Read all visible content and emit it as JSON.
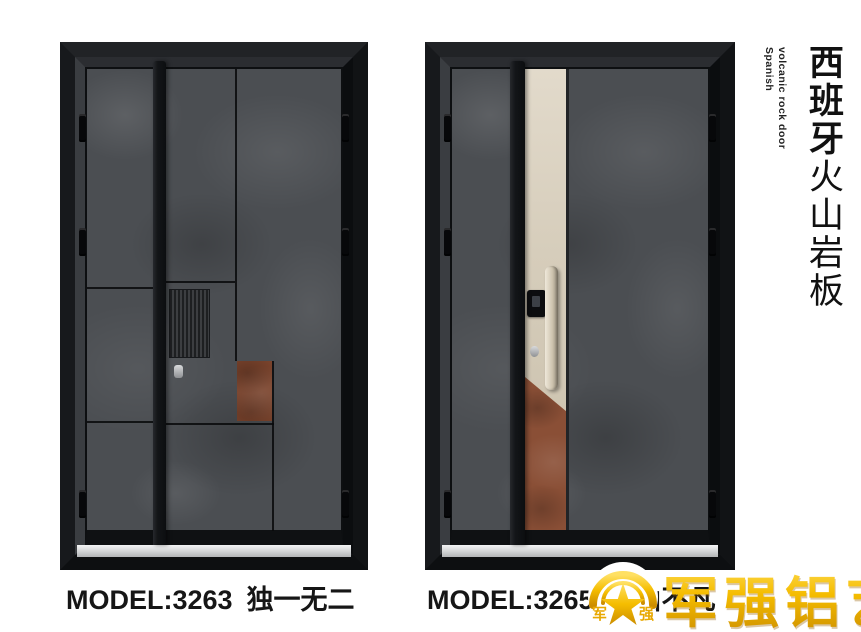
{
  "products": [
    {
      "model": "MODEL:3263",
      "name": "独一无二"
    },
    {
      "model": "MODEL:3265",
      "name": "层山不凡"
    }
  ],
  "side_label": {
    "zh_bold": "西班牙",
    "zh_regular": "火山岩板",
    "en_line1": "Spanish",
    "en_line2": "volcanic rock door"
  },
  "logo": {
    "brand": "军强铝艺",
    "emblem_left_char": "军",
    "emblem_right_char": "强"
  },
  "colors": {
    "stone_gray": "#4b4e52",
    "frame_black": "#121416",
    "champagne": "#d6cdbb",
    "rust": "#8a4f36",
    "rust_dark": "#7a432c",
    "gold": "#f5bd00",
    "threshold": "#d8dadb",
    "text": "#161616"
  }
}
